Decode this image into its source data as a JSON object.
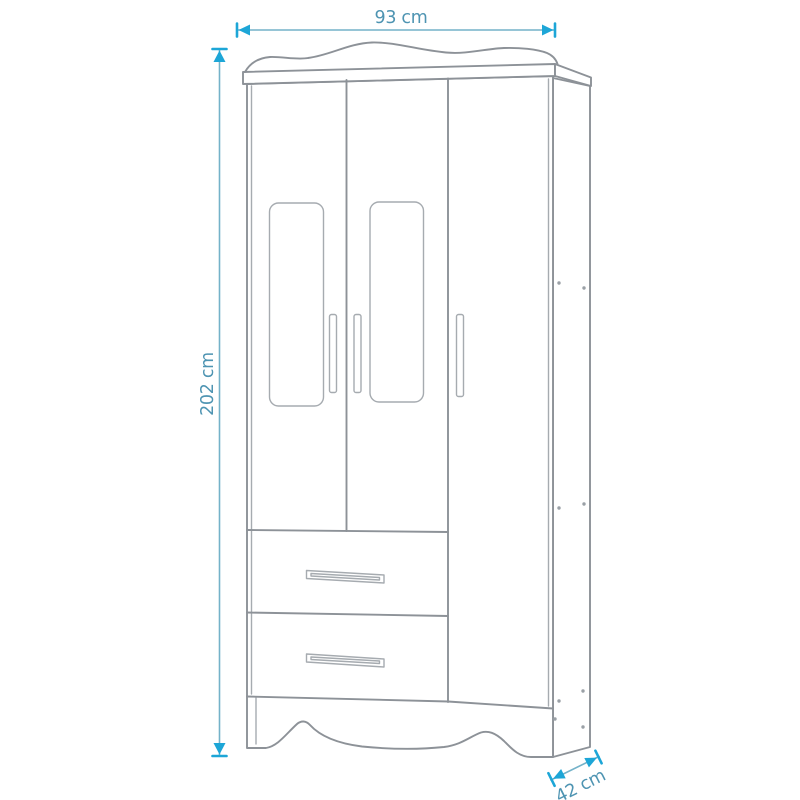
{
  "diagram": {
    "kind": "furniture-dimension-drawing",
    "subject": "three-door wardrobe with two drawers",
    "labels": {
      "width": "93 cm",
      "height": "202 cm",
      "depth": "42 cm"
    },
    "colors": {
      "accent": "#1da6d7",
      "dim_line": "#74b2c9",
      "dim_text": "#4e94b2",
      "outline": "#8d9298",
      "outline_light": "#a6abb0",
      "background": "#ffffff"
    }
  }
}
